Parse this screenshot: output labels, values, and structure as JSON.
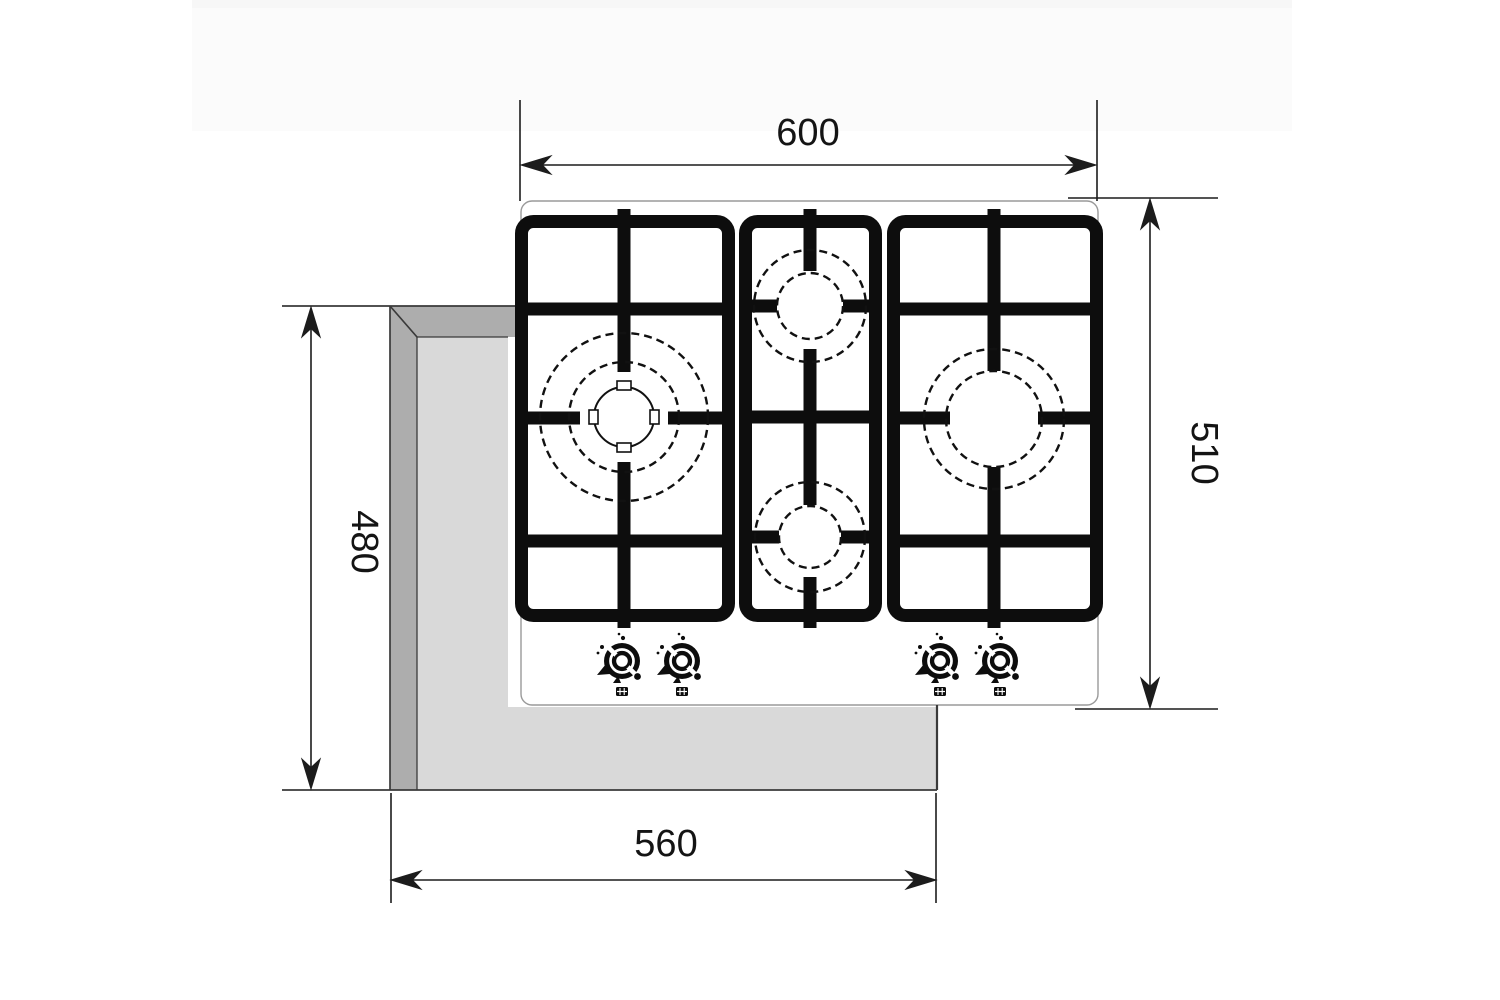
{
  "diagram": {
    "title": "gas-hob-installation-drawing-top-view",
    "dimension_labels": {
      "hob_width": "600",
      "hob_depth": "510",
      "cutout_depth": "480",
      "cutout_width": "560"
    },
    "colors": {
      "line": "#1c1c1c",
      "grate": "#0d0d0d",
      "counter_dark": "#adadad",
      "counter_light": "#d9d9d9",
      "top_band": "#fbfbfb",
      "panel_outline": "#9a9a9a"
    },
    "burners": [
      "triple-crown-large-left",
      "auxiliary-middle-top",
      "auxiliary-middle-bottom",
      "semi-rapid-right"
    ],
    "knobs_count": "4"
  }
}
